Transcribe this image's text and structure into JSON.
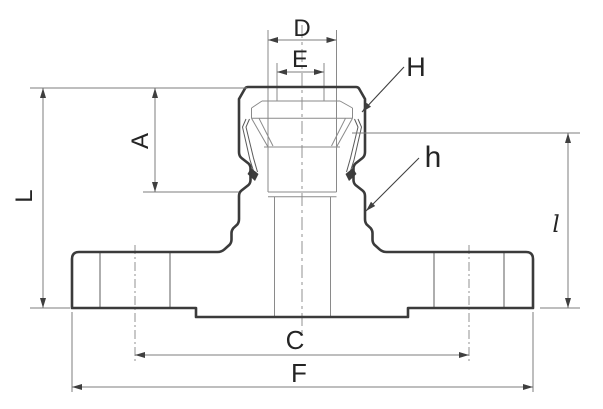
{
  "drawing": {
    "type": "engineering-cross-section",
    "description": "Flanged compression fitting section view with dimension callouts",
    "labels": {
      "D": "D",
      "E": "E",
      "H": "H",
      "A": "A",
      "L": "L",
      "h": "h",
      "C": "C",
      "F": "F",
      "l": "l"
    }
  },
  "colors": {
    "bg": "#ffffff",
    "outline": "#3b3b3b",
    "thin": "#8a8a8a",
    "dim": "#7c7c7c",
    "label": "#242424"
  }
}
